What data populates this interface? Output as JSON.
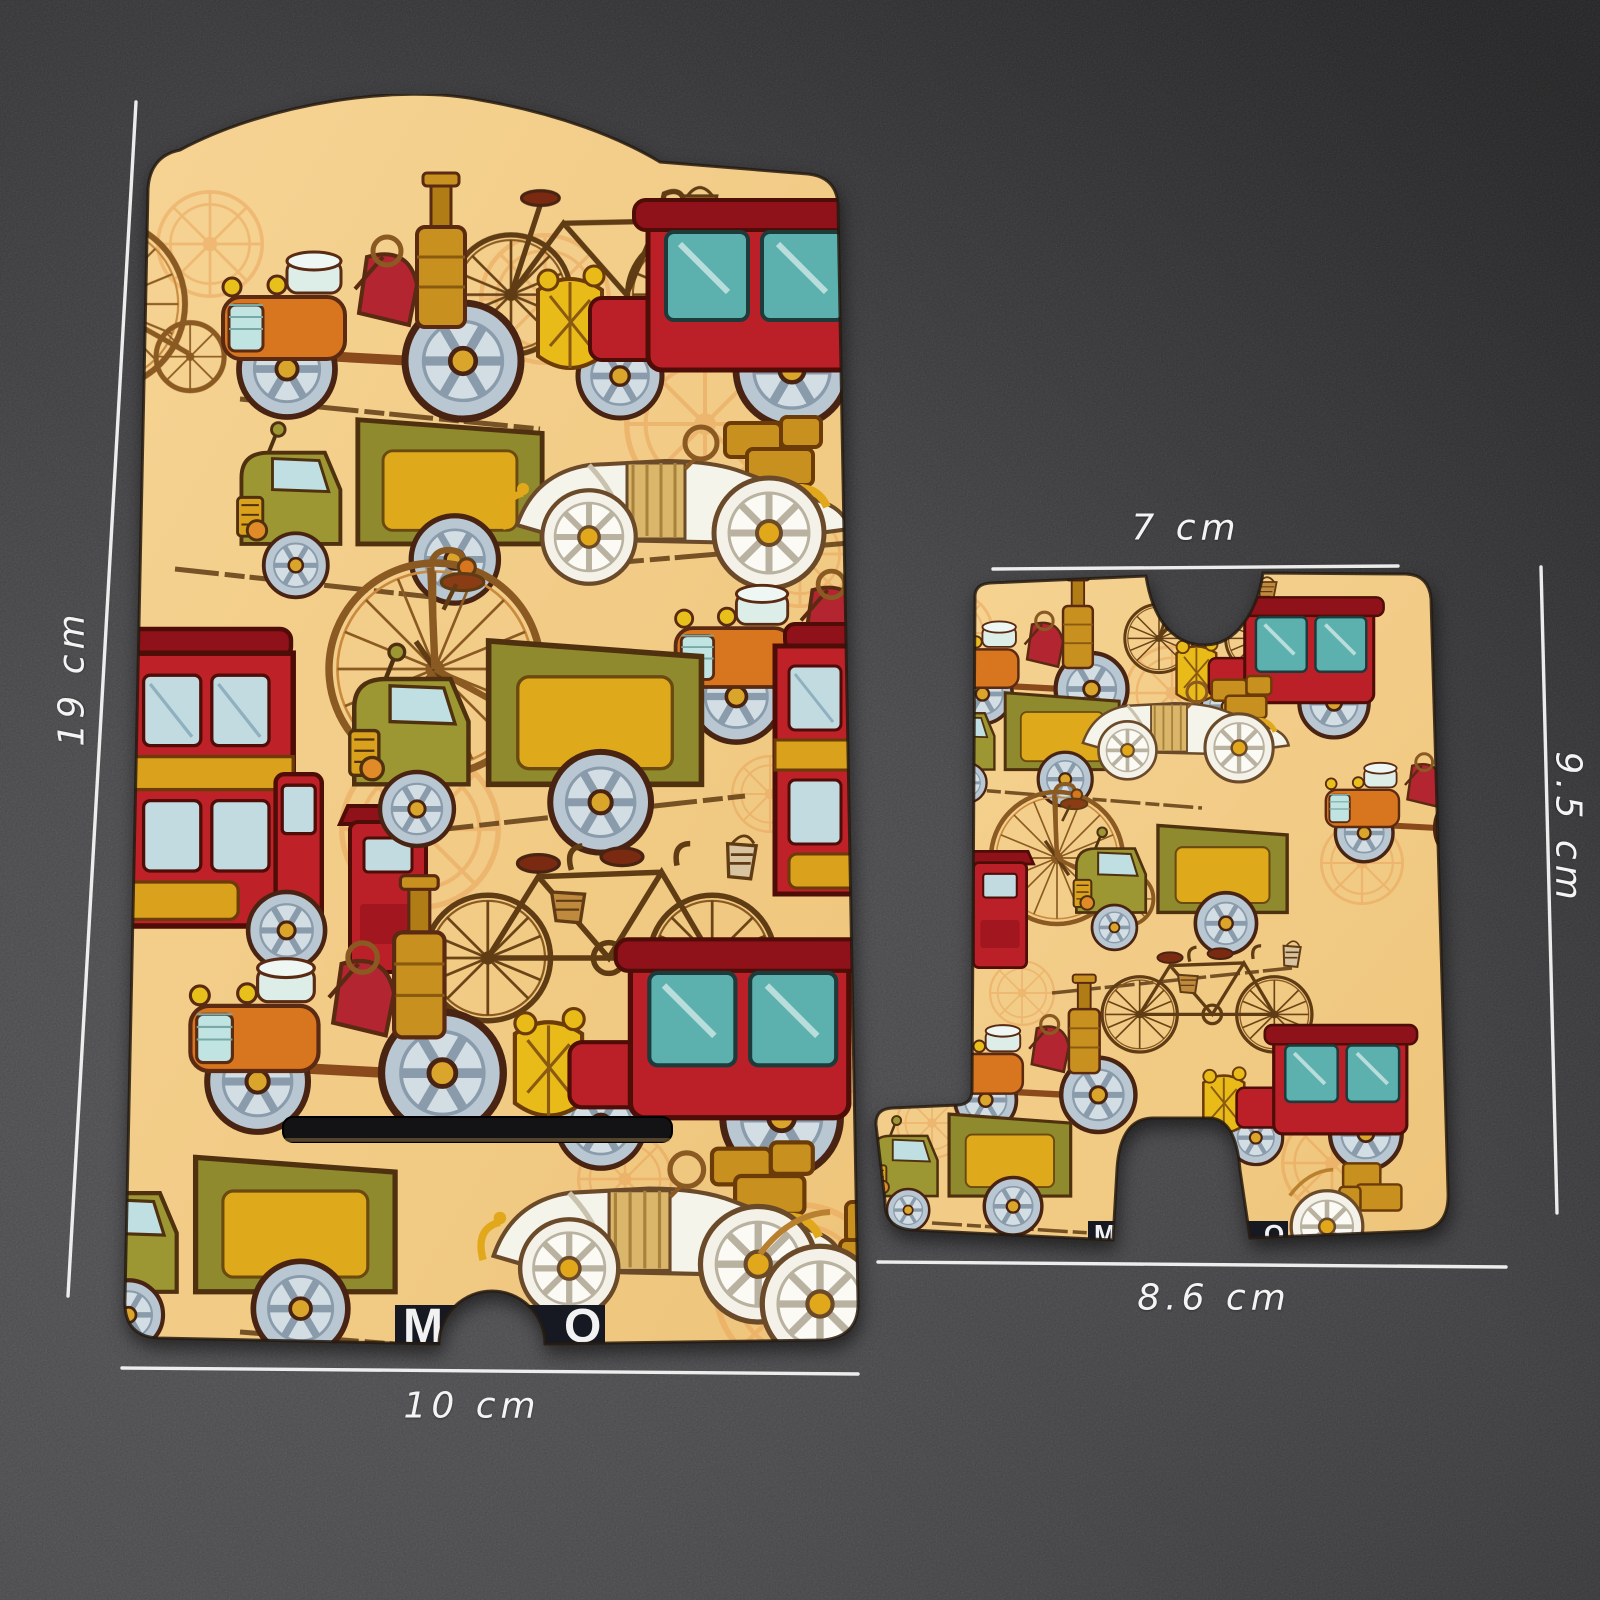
{
  "scene": {
    "type": "product-photo",
    "surface": "dark speckled slate background"
  },
  "product": {
    "name": "Vintage transport patterned phone stand - two flat board pieces",
    "pattern_motifs": [
      "steam-car-icon",
      "carriage-car-icon",
      "delivery-truck-icon",
      "double-decker-bus-icon",
      "penny-farthing-icon",
      "tandem-bicycle-icon",
      "race-car-icon",
      "bicycle-basket-icon",
      "sketch-wheel-icon"
    ],
    "logo": {
      "left_letter": "M",
      "right_letter": "O"
    }
  },
  "annotations": {
    "back_plate_height": "19 cm",
    "back_plate_width": "10 cm",
    "base_top_width": "7 cm",
    "base_height": "9.5 cm",
    "base_bottom_width": "8.6 cm"
  },
  "colors": {
    "pattern_background": "#f3cc86",
    "accent_red": "#bb2028",
    "accent_olive": "#8f8a2e",
    "accent_gold": "#dfa91c",
    "wheel_blue_gray": "#b9c7d2",
    "sketch_orange": "#e8a057",
    "dimension_line_white": "#f4f4f4",
    "surface_dark_gray": "#3c3c3f",
    "logo_band_dark": "#171922"
  }
}
